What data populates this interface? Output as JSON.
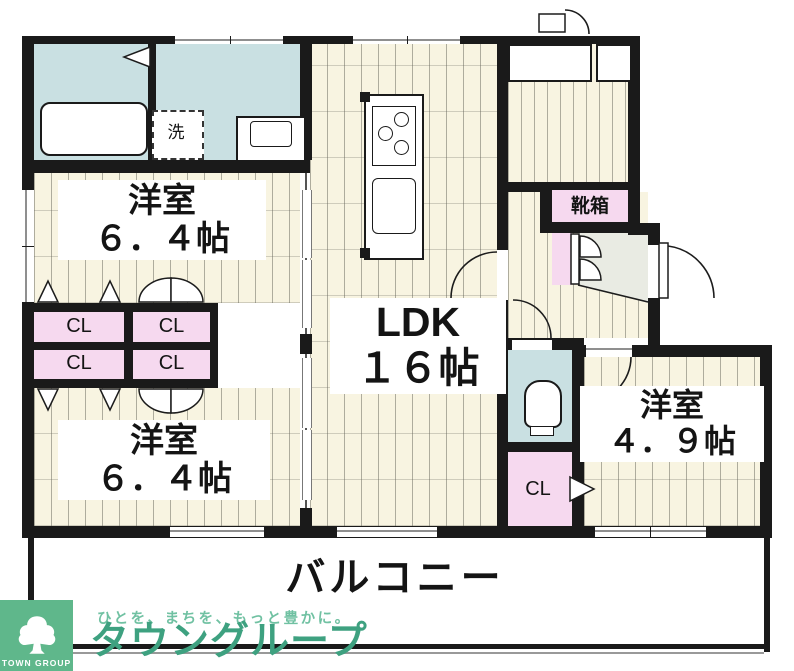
{
  "floorplan": {
    "rooms": {
      "bedroom_top_left": {
        "name": "洋室",
        "size": "６．４帖"
      },
      "bedroom_bottom_left": {
        "name": "洋室",
        "size": "６．４帖"
      },
      "bedroom_right": {
        "name": "洋室",
        "size": "４．９帖"
      },
      "ldk": {
        "name": "LDK",
        "size": "１６帖"
      },
      "balcony": {
        "name": "バルコニー"
      }
    },
    "labels": {
      "closet": "CL",
      "shoe_box": "靴箱",
      "washing_machine": "洗"
    },
    "colors": {
      "wall": "#1a1a1a",
      "wet_area_teal": "#c9e0e2",
      "closet_pink": "#f6d9ef",
      "flooring_cream": "#f8f4e1",
      "entry_gray": "#e9ebe3"
    }
  },
  "branding": {
    "badge": "TOWN GROUP",
    "tagline": "ひとを、まちを、もっと豊かに。",
    "brand_name": "タウングループ",
    "brand_green": "#3ea180",
    "logo_green": "#5fb78b"
  }
}
